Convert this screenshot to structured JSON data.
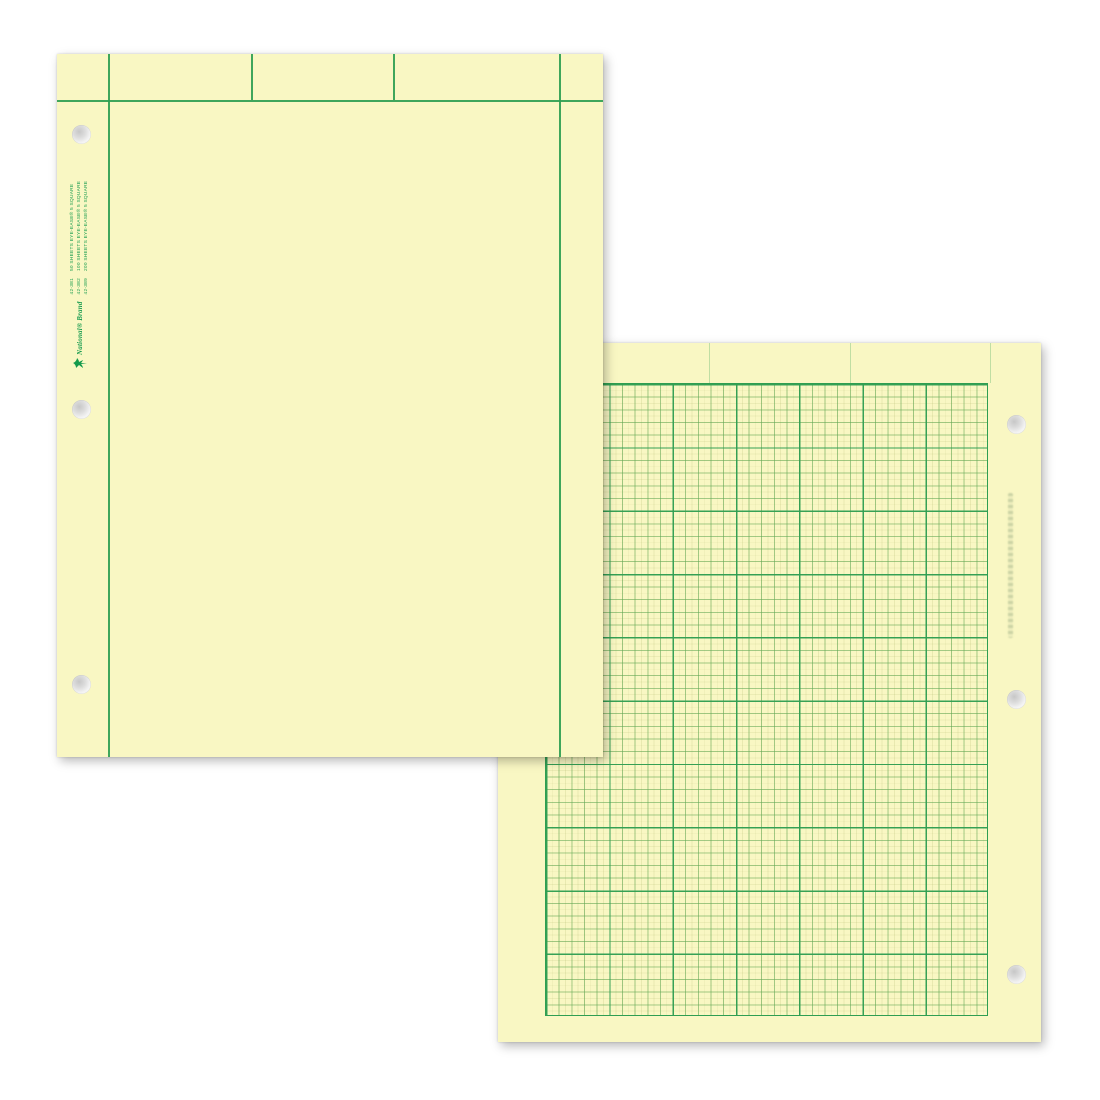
{
  "scene": {
    "description": "Two overlapping sheets of green-tint computation pad paper: plain ruled front side and 5x5 graph grid back side",
    "background_color": "#ffffff"
  },
  "colors": {
    "paper": "#f9f7c3",
    "rule_green": "#2f9e52",
    "fine_grid_green": "#9cc47c",
    "brand_green": "#149a4c",
    "hole_gray": "#c7c7c7"
  },
  "front_sheet": {
    "legend": {
      "brand": "National® Brand",
      "items": [
        {
          "code": "42-381",
          "desc": "50 SHEETS EYE-EASE® 5 SQUARE"
        },
        {
          "code": "42-382",
          "desc": "100 SHEETS EYE-EASE® 5 SQUARE"
        },
        {
          "code": "42-389",
          "desc": "200 SHEETS EYE-EASE® 5 SQUARE"
        }
      ]
    },
    "header": {
      "columns": 3,
      "hole_count": 3
    }
  },
  "back_sheet": {
    "grid": {
      "squares_per_major": 5,
      "major_columns": 7,
      "major_rows": 10,
      "hole_count": 3
    }
  }
}
